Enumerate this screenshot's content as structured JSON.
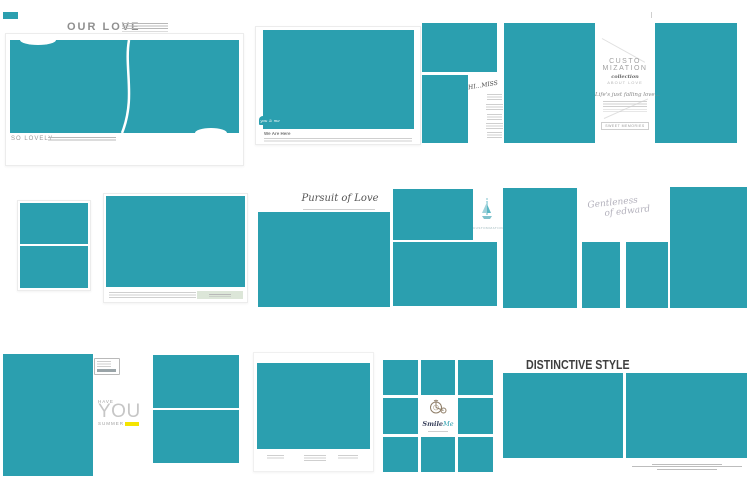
{
  "colors": {
    "teal": "#2B9FAF",
    "yellow": "#F4E400",
    "sage": "#DCE6D8",
    "title_gray": "#8F8F8F",
    "dark": "#3F3F3F"
  },
  "row1": {
    "our_love": {
      "title": "OUR LOVE",
      "footer": "SO LOVELY"
    },
    "we_are_here": {
      "badge": "you & me",
      "caption": "We Are Here"
    },
    "hi_miss": {
      "title": "HI...MISS"
    },
    "customization": {
      "title_line1": "CUSTO",
      "title_line2": "MIZATION",
      "divider_word": "collection",
      "subtitle": "ABOUT LOVE",
      "script": "Life's just falling love...",
      "stamp": "SWEET MEMORIES"
    }
  },
  "row2": {
    "pursuit": {
      "title": "Pursuit of Love"
    },
    "sail_label": "CUSTOMIZATION",
    "gentleness": {
      "line1": "Gentleness",
      "line2": "of edward"
    }
  },
  "row3": {
    "summer": {
      "word1": "HAVE",
      "word2": "YOU",
      "word3": "SUMMER"
    },
    "smile": {
      "word1": "Smile",
      "word2": "Me"
    },
    "distinctive": {
      "title": "DISTINCTIVE STYLE"
    }
  }
}
